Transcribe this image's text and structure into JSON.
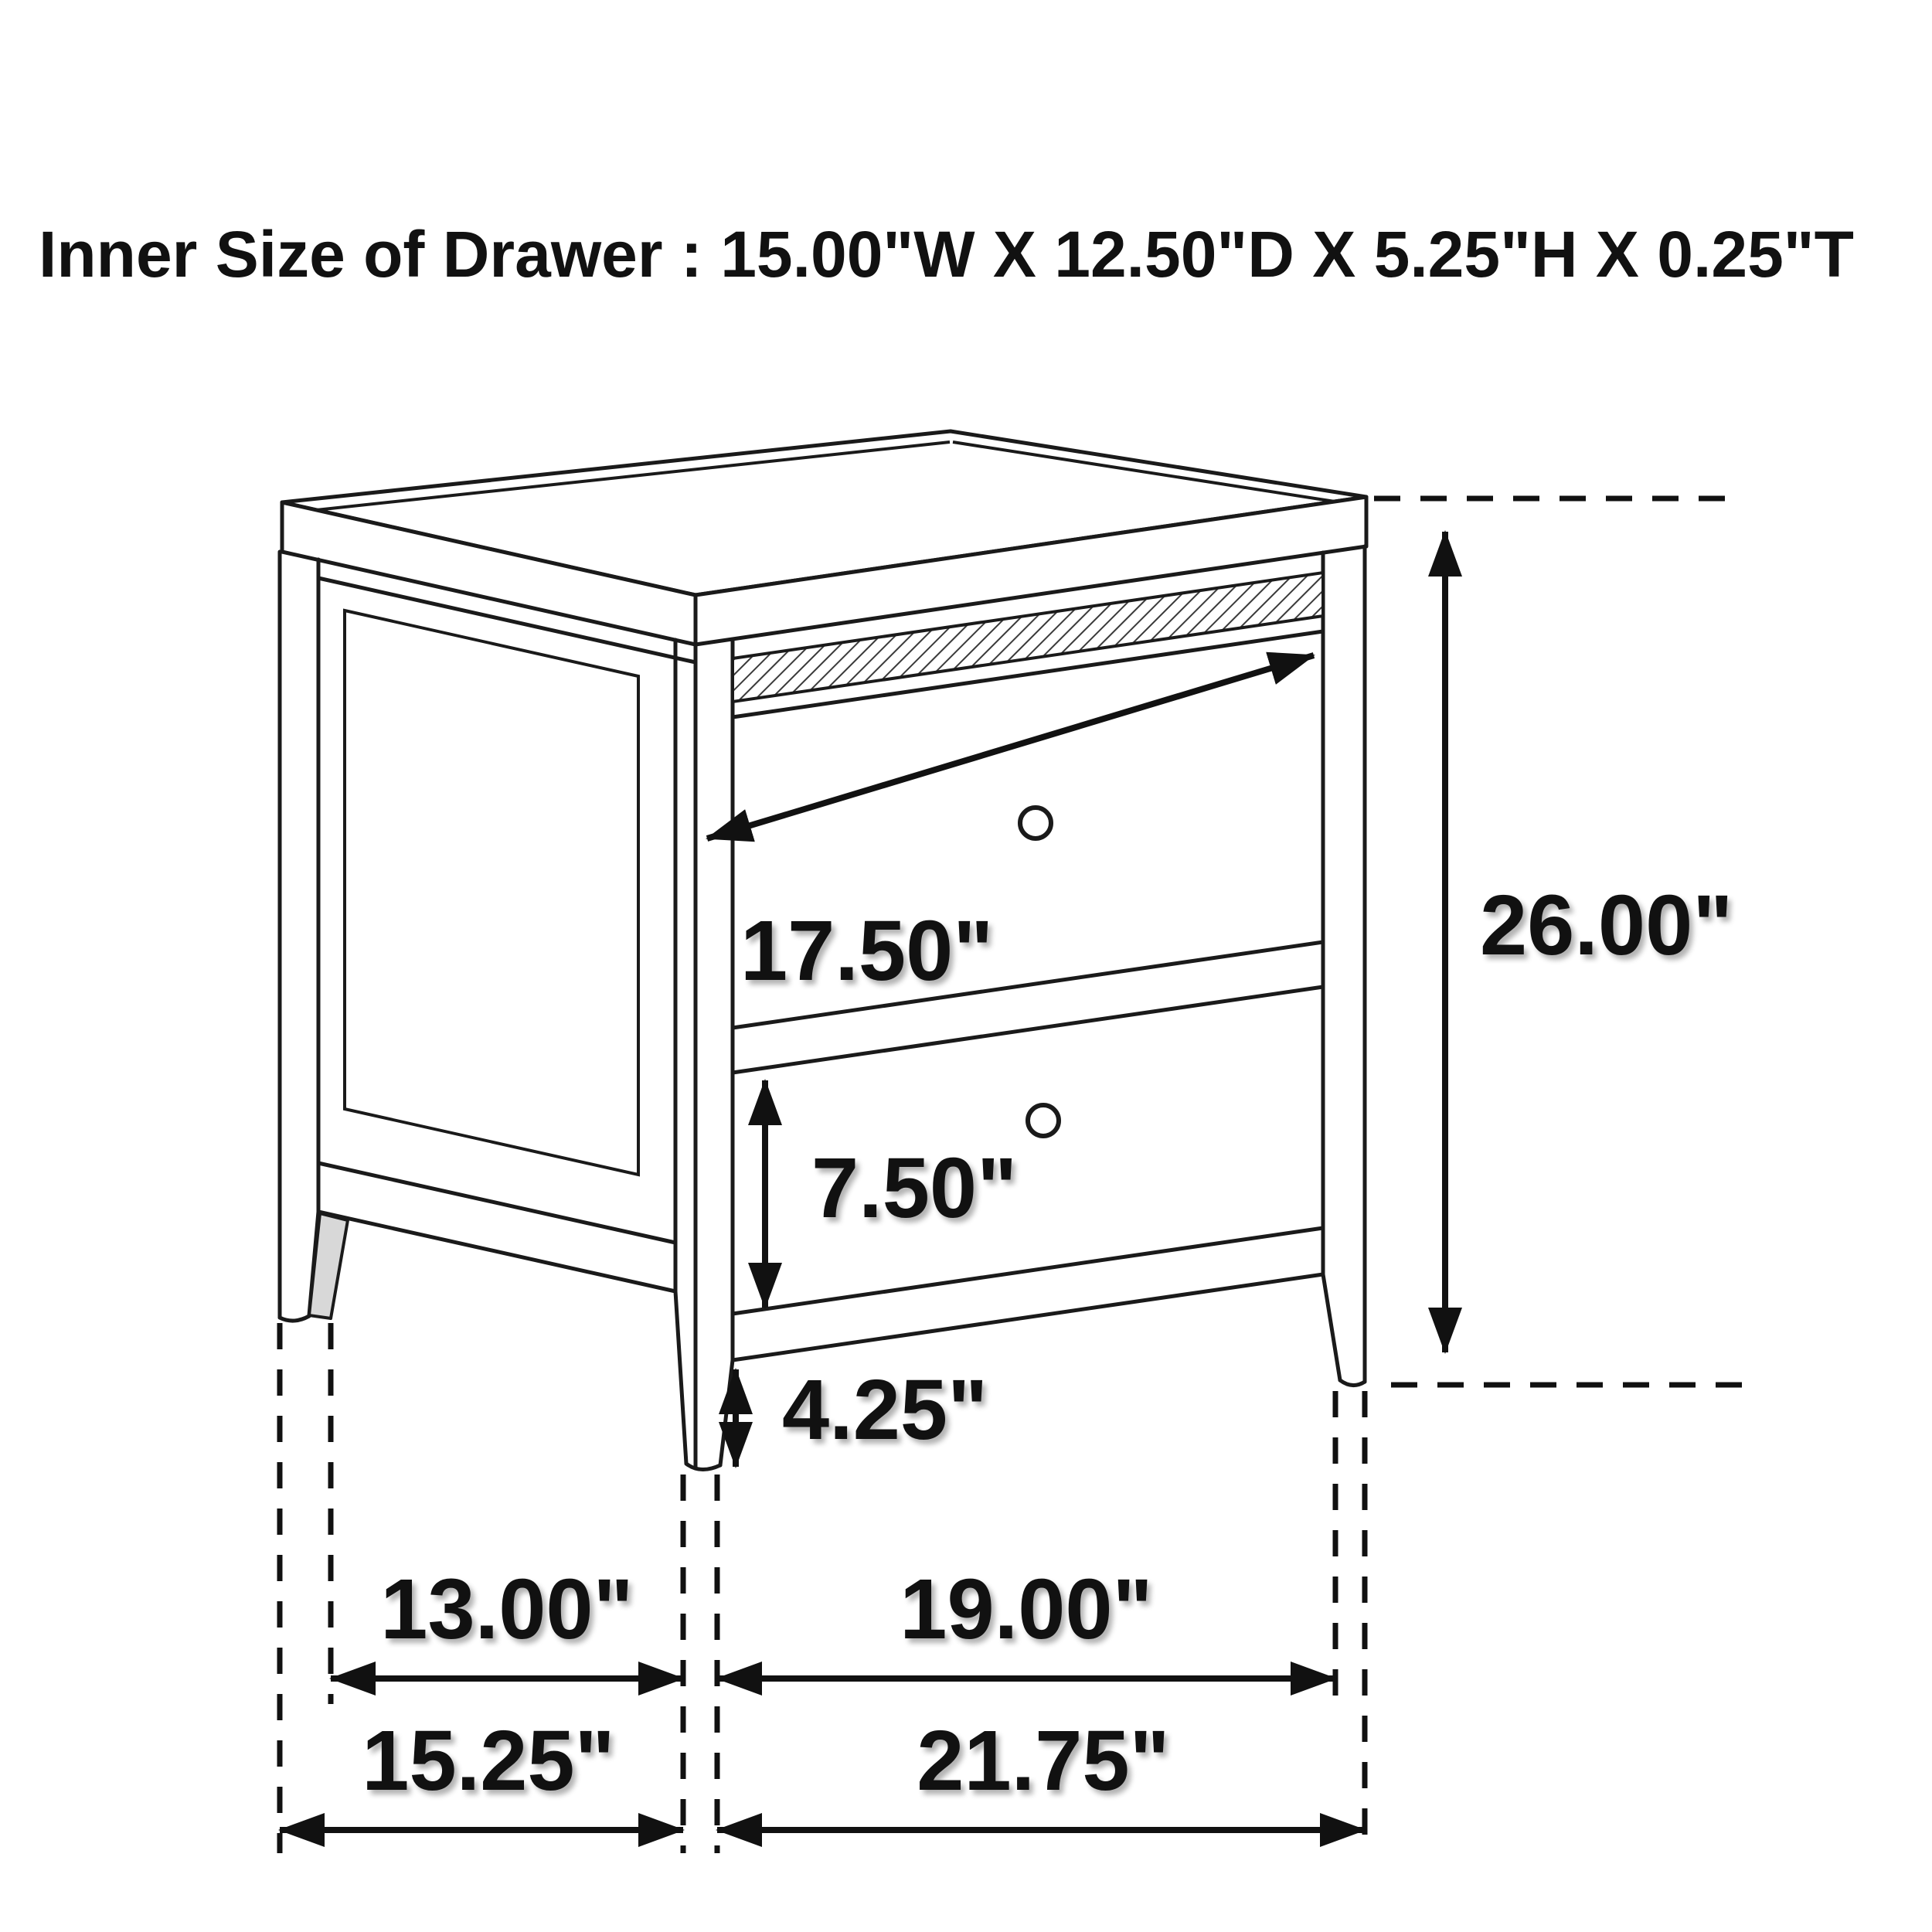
{
  "title": {
    "text": "Inner Size of Drawer : 15.00\"W X 12.50\"D X 5.25\"H X 0.25\"T"
  },
  "drawing": {
    "item": "two-drawer nightstand, isometric technical line drawing",
    "drawer_count": 2,
    "knob_count": 2,
    "inner_drawer_size": {
      "width": "15.00\"",
      "depth": "12.50\"",
      "height": "5.25\"",
      "thickness": "0.25\""
    }
  },
  "dimensions": {
    "top_drawer_width": {
      "label": "17.50\""
    },
    "overall_height": {
      "label": "26.00\""
    },
    "bottom_drawer_height": {
      "label": "7.50\""
    },
    "leg_height": {
      "label": "4.25\""
    },
    "side_inner_span": {
      "label": "13.00\""
    },
    "overall_depth": {
      "label": "15.25\""
    },
    "front_inner_span": {
      "label": "19.00\""
    },
    "overall_width": {
      "label": "21.75\""
    }
  },
  "colors": {
    "line": "#1a1a1a",
    "label": "#111111",
    "background": "#ffffff",
    "shade": "#d8d8d8"
  }
}
